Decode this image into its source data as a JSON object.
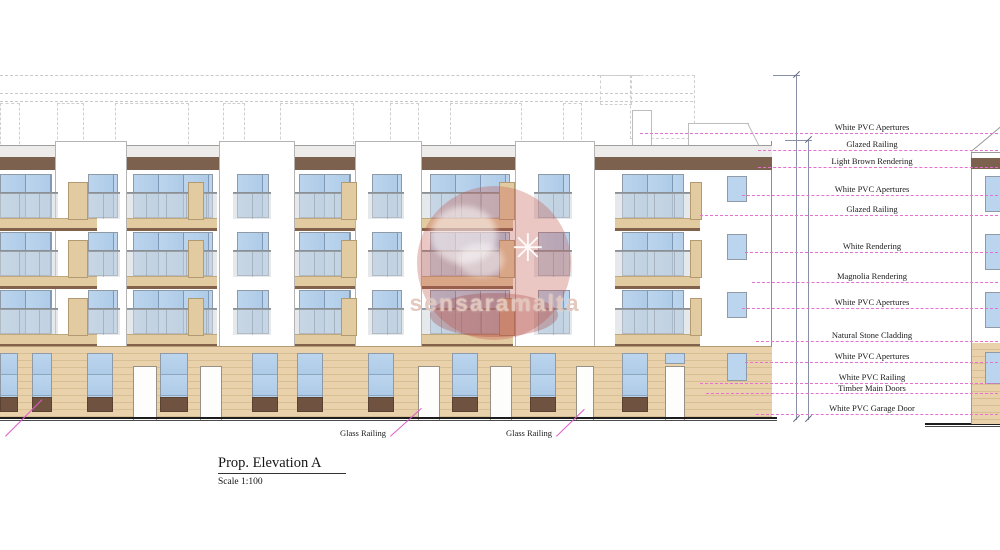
{
  "drawing": {
    "title": "Prop. Elevation A",
    "scale": "Scale 1:100"
  },
  "watermark": {
    "text": "sensaramalta",
    "star_icon": "✳"
  },
  "annotations": [
    {
      "label": "White PVC Apertures"
    },
    {
      "label": "Glazed Railing"
    },
    {
      "label": "Light Brown Rendering"
    },
    {
      "label": "White PVC Apertures"
    },
    {
      "label": "Glazed Railing"
    },
    {
      "label": "White Rendering"
    },
    {
      "label": "Magnolia Rendering"
    },
    {
      "label": "White PVC Apertures"
    },
    {
      "label": "Natural Stone Cladding"
    },
    {
      "label": "White PVC Apertures"
    },
    {
      "label": "White PVC Railing"
    },
    {
      "label": "Timber Main Doors"
    },
    {
      "label": "White PVC Garage Door"
    }
  ],
  "callouts": [
    {
      "label": "Glass Railing"
    },
    {
      "label": "Glass Railing"
    }
  ],
  "colors": {
    "brown_band": "#7d614f",
    "slab_beige": "#e3cba1",
    "stone_cladding": "#e8d1ab",
    "window_blue": "#bcd5ee",
    "railing_glass": "#d0d7dd",
    "panel_brown": "#6f5340",
    "leader_magenta": "#e570cf",
    "watermark_red": "#c45c52"
  }
}
